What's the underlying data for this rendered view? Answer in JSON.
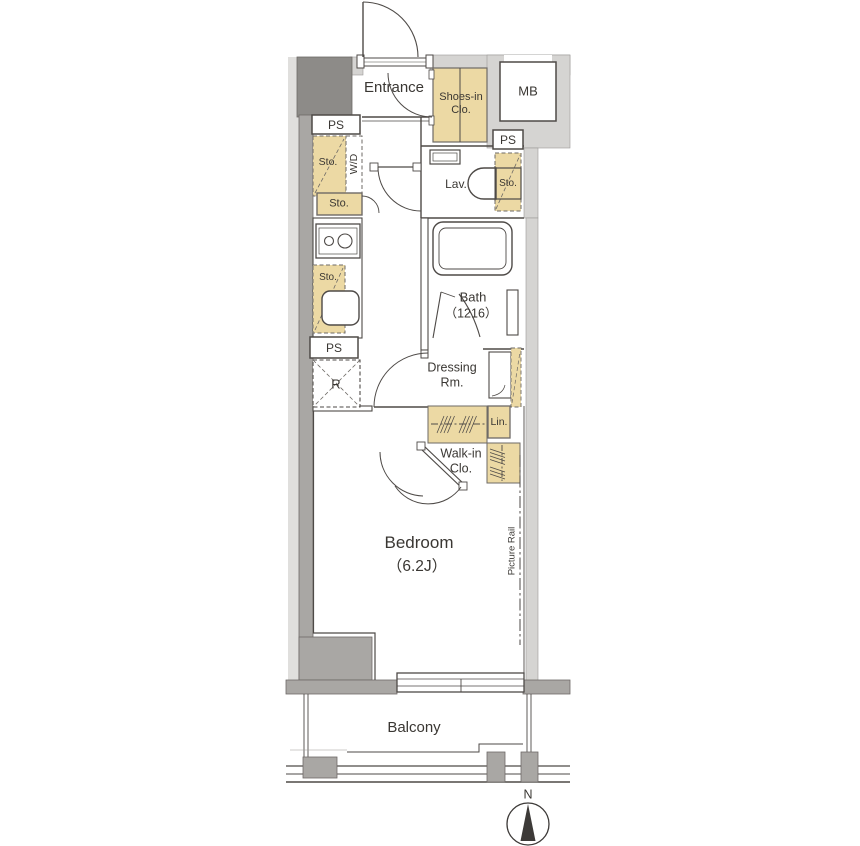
{
  "floor_plan": {
    "labels": {
      "entrance": "Entrance",
      "shoes_in_closet": "Shoes-in\nClo.",
      "meter_box": "MB",
      "ps_top": "PS",
      "ps_right": "PS",
      "ps_bottom": "PS",
      "storage_wd": "Sto.",
      "washer_dryer": "W/D",
      "storage_hall": "Sto.",
      "lavatory": "Lav.",
      "storage_lavatory": "Sto.",
      "storage_kitchen": "Sto.",
      "refrigerator": "R",
      "bath_name": "Bath",
      "bath_size": "（1216）",
      "dressing_room": "Dressing\nRm.",
      "linen": "Lin.",
      "walk_in_closet": "Walk-in\nClo.",
      "bedroom_name": "Bedroom",
      "bedroom_size": "（6.2J）",
      "picture_rail": "Picture Rail",
      "balcony": "Balcony",
      "compass_north": "N"
    },
    "colors": {
      "wall_light": "#d5d4d2",
      "wall_medium": "#a9a7a4",
      "wall_dark": "#8d8b88",
      "storage_fill": "#ecd9a4",
      "line": "#4e4a47",
      "background": "#ffffff"
    }
  }
}
